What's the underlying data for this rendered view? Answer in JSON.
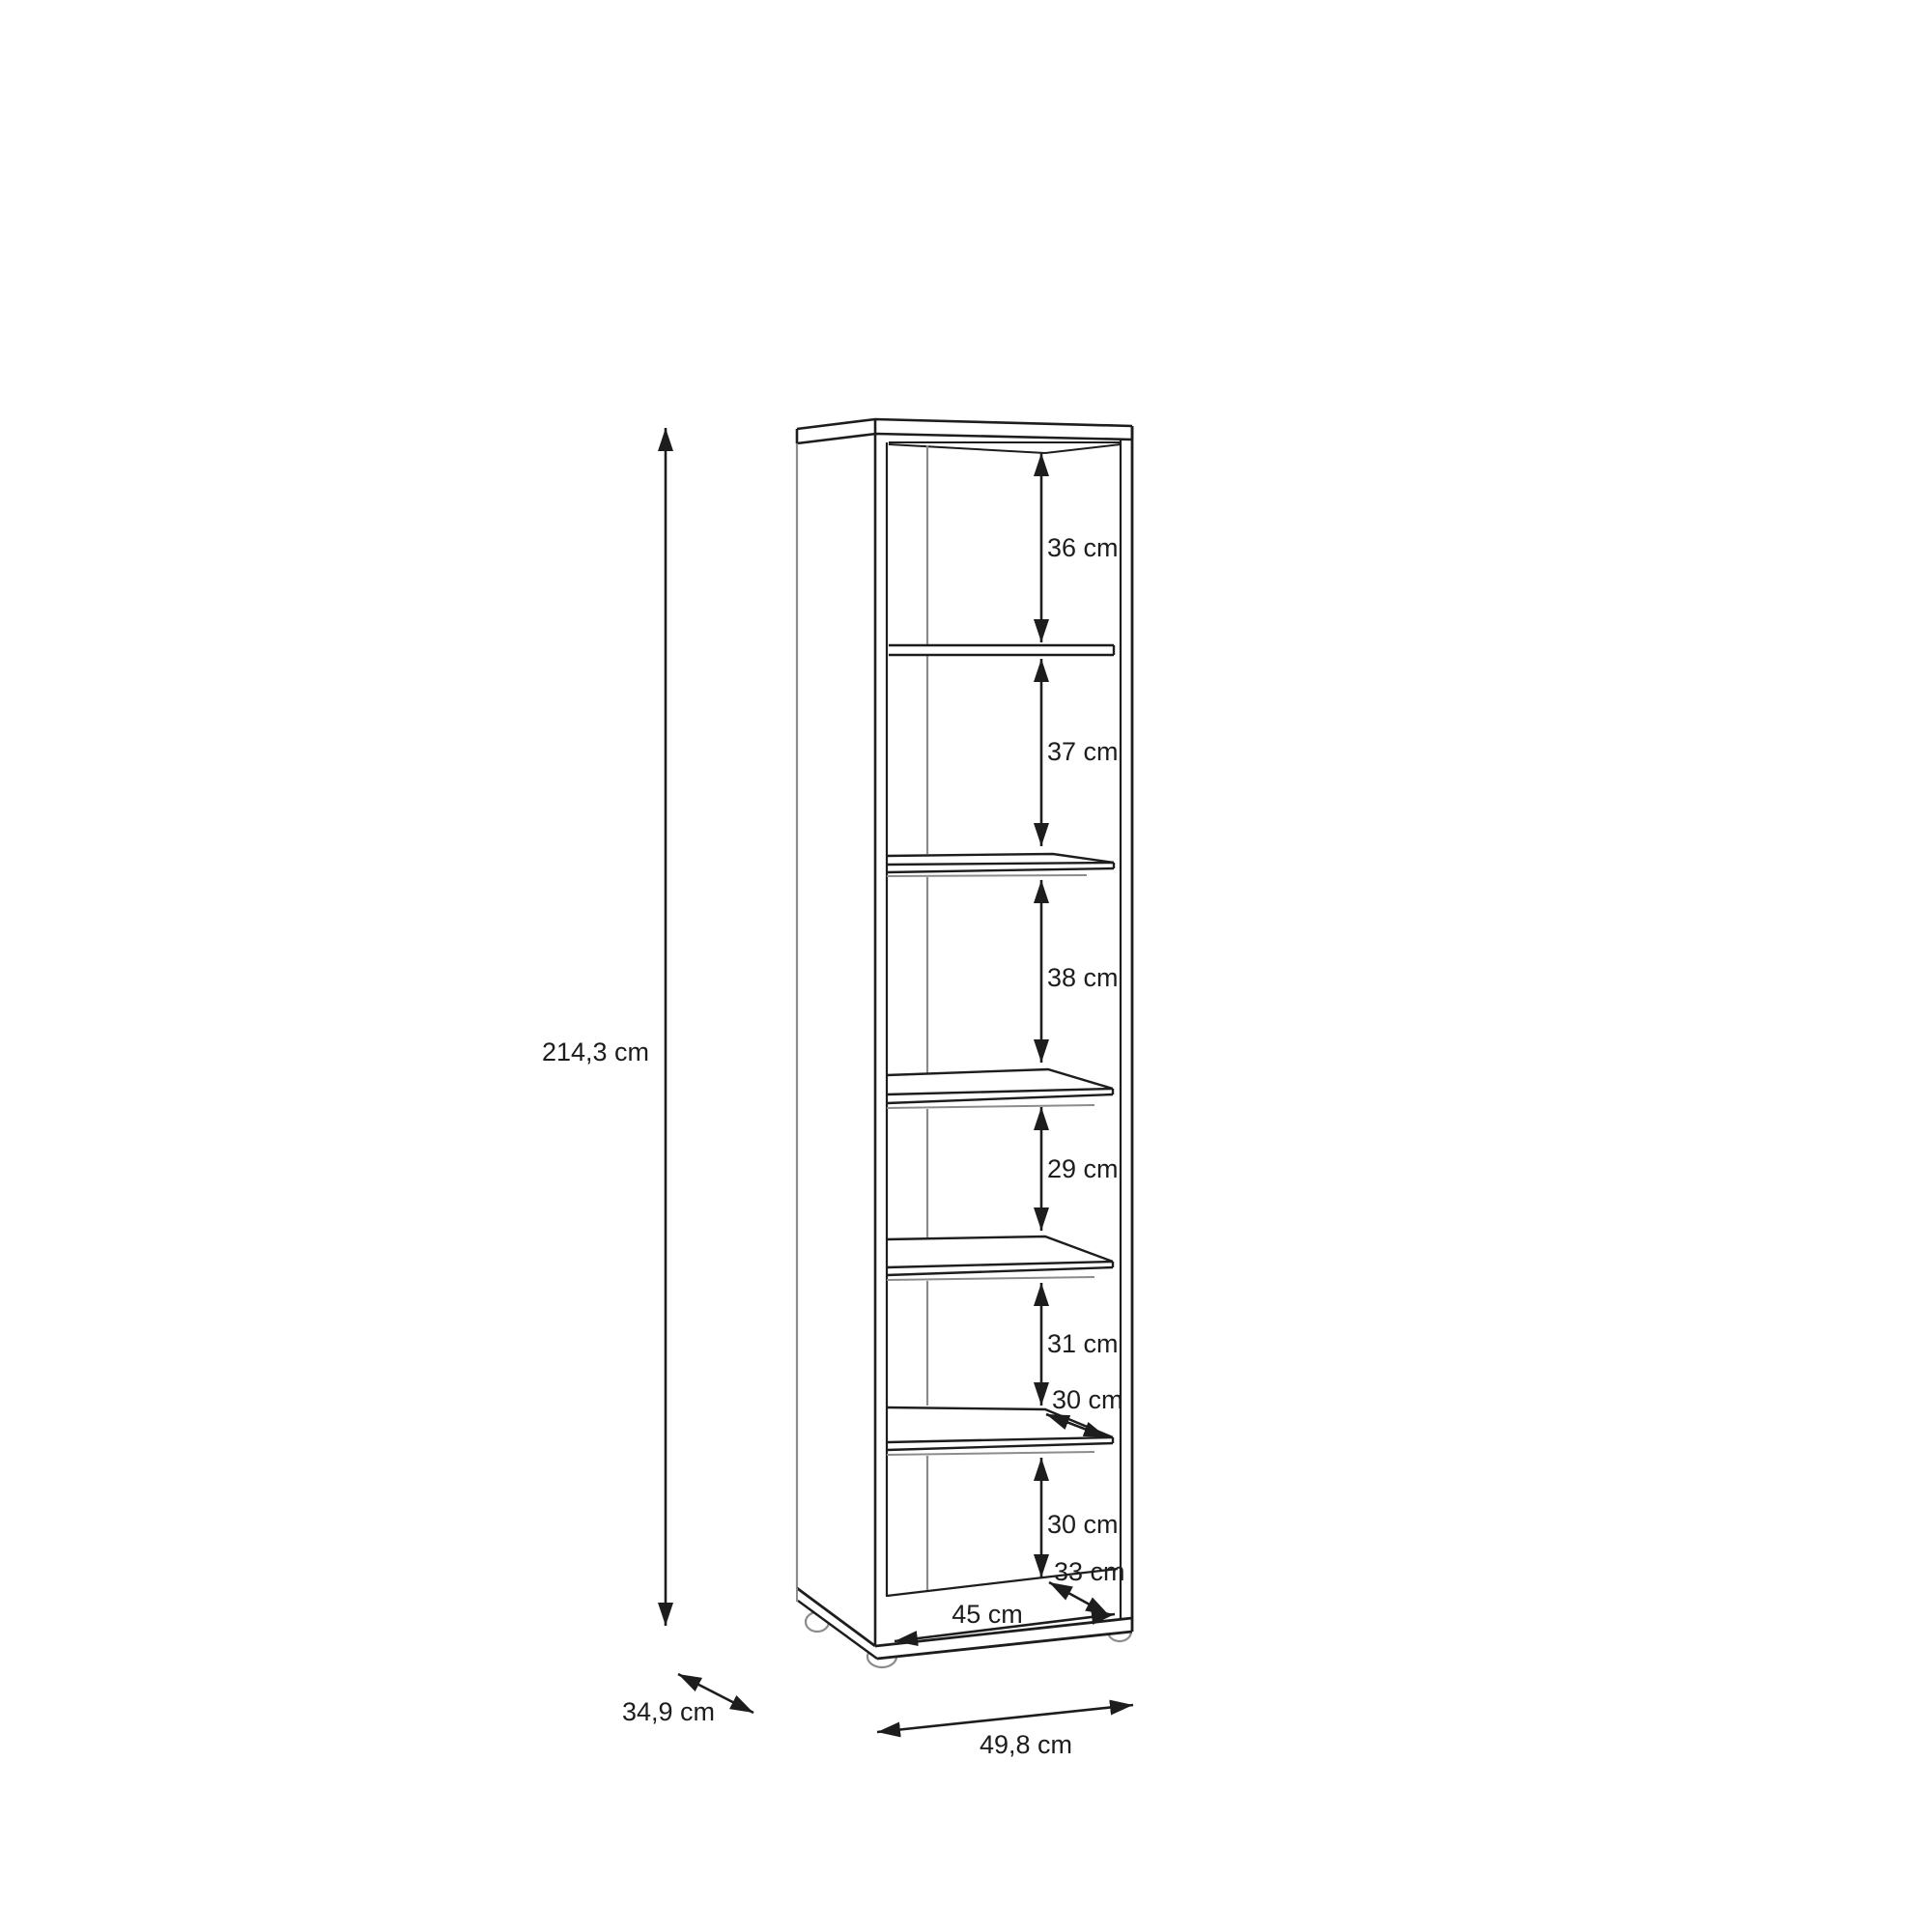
{
  "diagram": {
    "kind": "furniture-dimension-drawing",
    "item": "tall-narrow-bookcase-with-shelves",
    "unit": "cm",
    "overall": {
      "height": {
        "label": "214,3 cm",
        "value": 214.3
      },
      "width": {
        "label": "49,8 cm",
        "value": 49.8
      },
      "depth": {
        "label": "34,9 cm",
        "value": 34.9
      }
    },
    "interior": {
      "inner_width": {
        "label": "45 cm",
        "value": 45
      },
      "shelf_depth": {
        "label": "30 cm",
        "value": 30
      },
      "bottom_inner_depth": {
        "label": "33 cm",
        "value": 33
      },
      "compartment_heights": [
        {
          "position": 1,
          "label": "36 cm",
          "value": 36
        },
        {
          "position": 2,
          "label": "37 cm",
          "value": 37
        },
        {
          "position": 3,
          "label": "38 cm",
          "value": 38
        },
        {
          "position": 4,
          "label": "29 cm",
          "value": 29
        },
        {
          "position": 5,
          "label": "31 cm",
          "value": 31
        },
        {
          "position": 6,
          "label": "30 cm",
          "value": 30
        }
      ]
    },
    "colors": {
      "line": "#1d1d1d",
      "line_soft": "#8c8c8c",
      "background": "#ffffff",
      "text": "#1d1d1d"
    }
  }
}
